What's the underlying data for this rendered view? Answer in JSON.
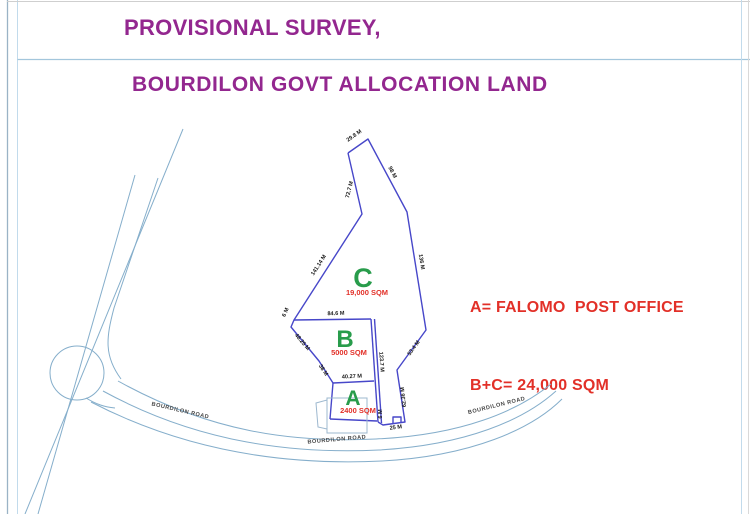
{
  "page": {
    "title": "PROVISIONAL SURVEY,",
    "subtitle": "BOURDILON GOVT ALLOCATION LAND"
  },
  "annotation": {
    "line1": "A= FALOMO  POST OFFICE",
    "line2": "B+C= 24,000 SQM"
  },
  "drawing": {
    "regions": [
      {
        "id": "C",
        "label": "C",
        "area": "19,000 SQM",
        "x": 363,
        "y": 287,
        "size": 27,
        "ax": 367,
        "ay": 295
      },
      {
        "id": "B",
        "label": "B",
        "area": "5000 SQM",
        "x": 345,
        "y": 347,
        "size": 24,
        "ax": 349,
        "ay": 355
      },
      {
        "id": "A",
        "label": "A",
        "area": "2400 SQM",
        "x": 353,
        "y": 405,
        "size": 21,
        "ax": 358,
        "ay": 413
      }
    ],
    "dimension_labels": [
      {
        "text": "29.8 M",
        "x": 355,
        "y": 137,
        "rot": -35
      },
      {
        "text": "98 M",
        "x": 391,
        "y": 173,
        "rot": 62
      },
      {
        "text": "72.7 M",
        "x": 351,
        "y": 190,
        "rot": -76
      },
      {
        "text": "141.14 M",
        "x": 320,
        "y": 266,
        "rot": -57
      },
      {
        "text": "136 M",
        "x": 420,
        "y": 262,
        "rot": 81
      },
      {
        "text": "84.6 M",
        "x": 336,
        "y": 315,
        "rot": -2
      },
      {
        "text": "6 M",
        "x": 287,
        "y": 313,
        "rot": -67
      },
      {
        "text": "48.25 M",
        "x": 301,
        "y": 343,
        "rot": 50
      },
      {
        "text": "38 M",
        "x": 322,
        "y": 371,
        "rot": 57
      },
      {
        "text": "40.27 M",
        "x": 352,
        "y": 378,
        "rot": -3
      },
      {
        "text": "123.7 M",
        "x": 380,
        "y": 362,
        "rot": 86
      },
      {
        "text": "53.4 M",
        "x": 415,
        "y": 349,
        "rot": -54
      },
      {
        "text": "62.36 M",
        "x": 405,
        "y": 397,
        "rot": -96
      },
      {
        "text": "6 M",
        "x": 382,
        "y": 414,
        "rot": -90
      },
      {
        "text": "25 M",
        "x": 396,
        "y": 429,
        "rot": -7
      }
    ],
    "road_labels": [
      {
        "text": "BOURDILON ROAD",
        "x": 180,
        "y": 412,
        "rot": 13
      },
      {
        "text": "BOURDILON ROAD",
        "x": 337,
        "y": 441,
        "rot": -5
      },
      {
        "text": "BOURDILON ROAD",
        "x": 497,
        "y": 407,
        "rot": -14
      }
    ],
    "colors": {
      "parcel_line": "#4747c9",
      "road_line": "#85aecb",
      "region_letter": "#289c4b",
      "area_text": "#e23028",
      "heading": "#93278f",
      "annotation_text": "#e23028",
      "dimension_text": "#1b1b1b"
    }
  }
}
